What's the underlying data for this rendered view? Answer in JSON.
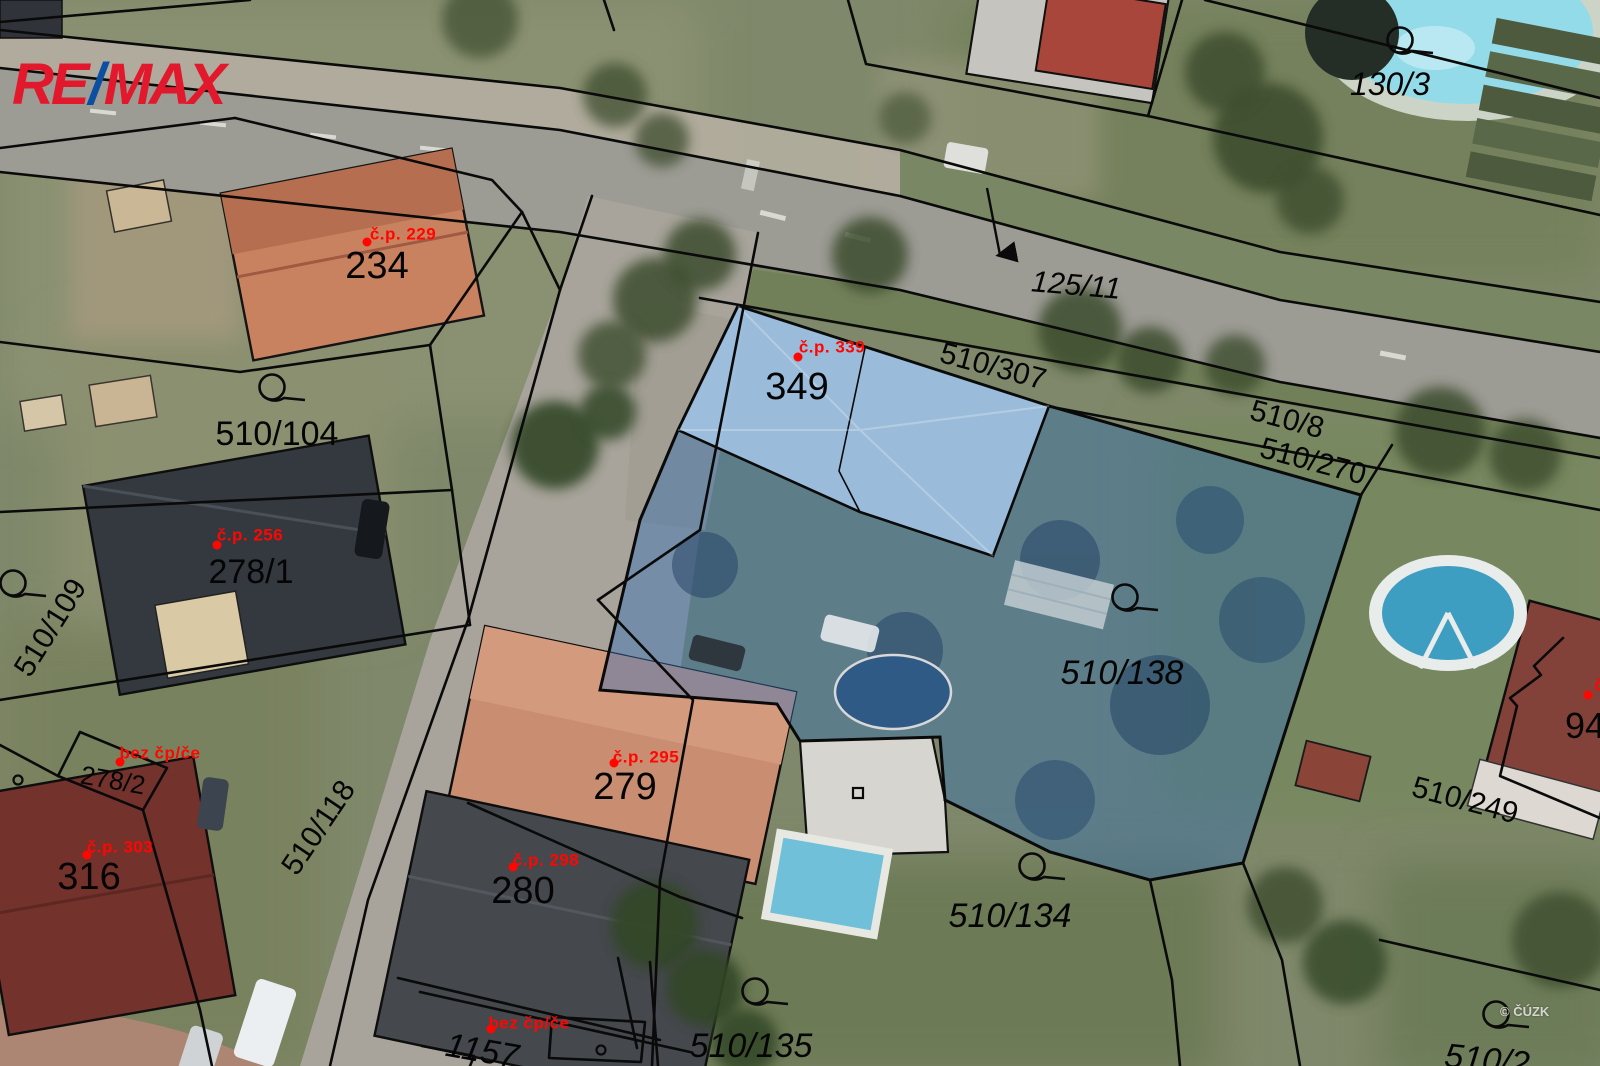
{
  "branding": {
    "re": "RE",
    "slash": "/",
    "max": "MAX",
    "red": "#e2192c",
    "blue": "#0b4ea2"
  },
  "watermark": {
    "text": "© ČÚZK"
  },
  "map": {
    "type": "cadastral-parcel-map-over-aerial-photo",
    "highlight": {
      "parcel_fill": "#2f6db5",
      "building_fill": "#a3c4e4"
    },
    "label_color_parcel": "#050505",
    "label_color_building": "#ff0600",
    "parcel_labels": [
      {
        "text": "234",
        "x": 377,
        "y": 266,
        "size": 38
      },
      {
        "text": "349",
        "x": 797,
        "y": 387,
        "size": 38
      },
      {
        "text": "125/11",
        "x": 1076,
        "y": 286,
        "size": 30,
        "rot": 5,
        "italic": true
      },
      {
        "text": "510/307",
        "x": 993,
        "y": 367,
        "size": 30,
        "rot": 15
      },
      {
        "text": "510/8",
        "x": 1287,
        "y": 420,
        "size": 30,
        "rot": 15
      },
      {
        "text": "510/270",
        "x": 1313,
        "y": 462,
        "size": 30,
        "rot": 15
      },
      {
        "text": "130/3",
        "x": 1390,
        "y": 84,
        "size": 32,
        "italic": true
      },
      {
        "text": "510/104",
        "x": 277,
        "y": 434,
        "size": 34
      },
      {
        "text": "278/1",
        "x": 251,
        "y": 572,
        "size": 34
      },
      {
        "text": "510/109",
        "x": 51,
        "y": 628,
        "size": 30,
        "rot": -58
      },
      {
        "text": "510/138",
        "x": 1122,
        "y": 673,
        "size": 34,
        "italic": true
      },
      {
        "text": "279",
        "x": 625,
        "y": 787,
        "size": 38
      },
      {
        "text": "280",
        "x": 523,
        "y": 891,
        "size": 38
      },
      {
        "text": "316",
        "x": 89,
        "y": 877,
        "size": 38
      },
      {
        "text": "278/2",
        "x": 113,
        "y": 780,
        "size": 26,
        "rot": 10
      },
      {
        "text": "510/118",
        "x": 319,
        "y": 828,
        "size": 30,
        "rot": -56
      },
      {
        "text": "510/249",
        "x": 1465,
        "y": 801,
        "size": 30,
        "rot": 15
      },
      {
        "text": "510/134",
        "x": 1010,
        "y": 916,
        "size": 34,
        "italic": true
      },
      {
        "text": "510/135",
        "x": 751,
        "y": 1046,
        "size": 34,
        "italic": true
      },
      {
        "text": "1157",
        "x": 482,
        "y": 1051,
        "size": 34,
        "rot": 10,
        "italic": true
      },
      {
        "text": "94",
        "x": 1585,
        "y": 726,
        "size": 36
      },
      {
        "text": "510/2",
        "x": 1487,
        "y": 1060,
        "size": 34,
        "rot": 6,
        "italic": true
      }
    ],
    "building_labels": [
      {
        "text": "č.p. 229",
        "x": 403,
        "y": 234,
        "dot_x": 367,
        "dot_y": 242
      },
      {
        "text": "č.p. 339",
        "x": 832,
        "y": 347,
        "dot_x": 798,
        "dot_y": 357
      },
      {
        "text": "č.p. 256",
        "x": 250,
        "y": 535,
        "dot_x": 217,
        "dot_y": 545
      },
      {
        "text": "č.p. 295",
        "x": 646,
        "y": 757,
        "dot_x": 614,
        "dot_y": 763
      },
      {
        "text": "č.p. 298",
        "x": 546,
        "y": 860,
        "dot_x": 513,
        "dot_y": 867
      },
      {
        "text": "č.p. 303",
        "x": 120,
        "y": 847,
        "dot_x": 87,
        "dot_y": 855
      },
      {
        "text": "bez čp/če",
        "x": 160,
        "y": 753,
        "dot_x": 120,
        "dot_y": 762
      },
      {
        "text": "bez čp/če",
        "x": 529,
        "y": 1023,
        "dot_x": 491,
        "dot_y": 1029
      },
      {
        "text": "č.p.",
        "x": 1610,
        "y": 685,
        "dot_x": 1588,
        "dot_y": 695
      }
    ],
    "reference_symbols": [
      {
        "x": 272,
        "y": 387
      },
      {
        "x": 1400,
        "y": 40
      },
      {
        "x": 13,
        "y": 583
      },
      {
        "x": 1125,
        "y": 597
      },
      {
        "x": 1032,
        "y": 866
      },
      {
        "x": 755,
        "y": 991
      },
      {
        "x": 1496,
        "y": 1014
      }
    ],
    "minor_building_symbols": [
      {
        "x": 18,
        "y": 780
      },
      {
        "x": 601,
        "y": 1050
      }
    ]
  }
}
